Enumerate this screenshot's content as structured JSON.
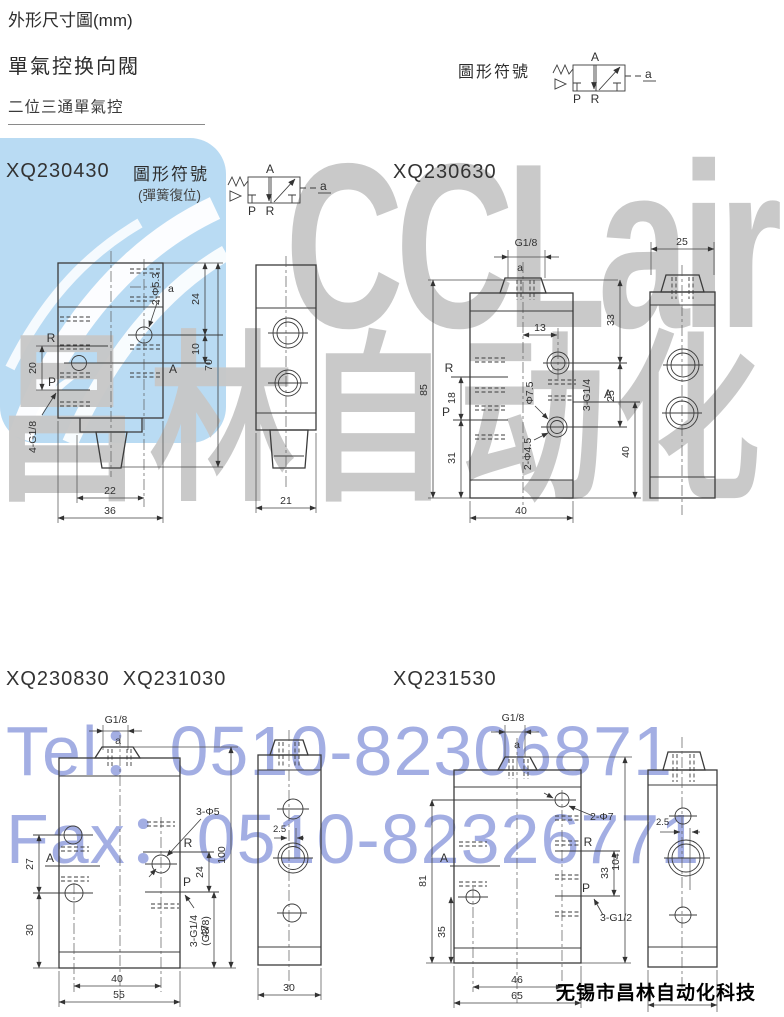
{
  "header": {
    "title": "外形尺寸圖(mm)",
    "subtitle": "單氣控换向閥",
    "section": "二位三通單氣控"
  },
  "symbol": {
    "label": "圖形符號",
    "sublabel": "(彈簧復位)",
    "A": "A",
    "P": "P",
    "R": "R",
    "a": "a"
  },
  "models": {
    "m430": {
      "name": "XQ230430",
      "front": {
        "a": "a",
        "hole": "2-Φ5.3",
        "d24": "24",
        "d10": "10",
        "d70": "70",
        "d20": "20",
        "d22": "22",
        "d36": "36",
        "R": "R",
        "P": "P",
        "A": "A",
        "thread": "4-G1/8"
      },
      "side": {
        "d21": "21"
      }
    },
    "m630": {
      "name": "XQ230630",
      "front": {
        "g": "G1/8",
        "a": "a",
        "d13": "13",
        "d33": "33",
        "d85": "85",
        "d18": "18",
        "d31": "31",
        "d25": "25",
        "d40r": "40",
        "d40b": "40",
        "holed": "Φ7.5",
        "hole2": "2-Φ4.5",
        "thread": "3-G1/4",
        "R": "R",
        "P": "P",
        "A": "A"
      },
      "side": {
        "d25": "25"
      }
    },
    "m830": {
      "name": "XQ230830",
      "name2": "XQ231030",
      "front": {
        "g": "G1/8",
        "a": "a",
        "d27": "27",
        "d30": "30",
        "d24": "24",
        "d47": "47",
        "d100": "100",
        "d40": "40",
        "d55": "55",
        "hole": "3-Φ5",
        "thread": "3-G1/4",
        "thread2": "(G3/8)",
        "R": "R",
        "P": "P",
        "A": "A"
      },
      "side": {
        "d25": "2.5",
        "d30": "30"
      }
    },
    "m1530": {
      "name": "XQ231530",
      "front": {
        "g": "G1/8",
        "a": "a",
        "d81": "81",
        "d35": "35",
        "d33": "33",
        "d104": "104",
        "d46": "46",
        "d65": "65",
        "hole": "2-Φ7",
        "thread": "3-G1/2",
        "R": "R",
        "P": "P",
        "A": "A"
      },
      "side": {
        "d25": "2.5"
      }
    }
  },
  "watermarks": {
    "brand": "CCLair",
    "cn": "昌林自动化",
    "tel": "Tel：0510-82306871",
    "fax": "Fax：0510-82326771",
    "company": "无锡市昌林自动化科技"
  },
  "colors": {
    "watermark_blue": "#b9dbf3",
    "watermark_gray": "#c9c9c9",
    "watermark_text_blue": "#a3aee3",
    "line": "#3b3b3b"
  }
}
